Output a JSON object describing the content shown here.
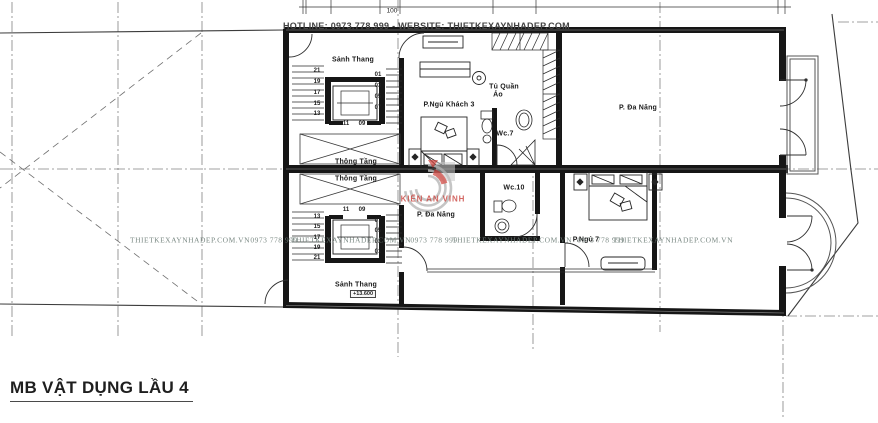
{
  "header": {
    "hotline": "HOTLINE: 0973.778.999 - WEBSITE: THIETKEXAYNHADEP.COM"
  },
  "title": {
    "text": "MB VẬT DỤNG LẦU 4"
  },
  "dimensions": {
    "top_width_label": "100"
  },
  "rooms": {
    "stair_hall_top": "Sảnh Thang",
    "guest_bedroom": "P.Ngủ Khách 3",
    "wardrobe_line1": "Tủ Quần",
    "wardrobe_line2": "Áo",
    "wc7": "Wc.7",
    "multi_top": "P. Đa Năng",
    "void_top": "Thông Tầng",
    "void_bottom": "Thông Tầng",
    "wc10": "Wc.10",
    "multi_bottom": "P. Đa Năng",
    "bedroom7": "P.Ngủ 7",
    "stair_hall_bottom": "Sảnh Thang",
    "stair_elevation": "+13.600"
  },
  "stairs": {
    "top": {
      "left": [
        "21",
        "19",
        "17",
        "15",
        "13"
      ],
      "mid": [
        "11",
        "09"
      ],
      "right": [
        "01",
        "03",
        "05",
        "07"
      ]
    },
    "bottom": {
      "mid": [
        "11",
        "09"
      ],
      "left": [
        "13",
        "15",
        "17",
        "19",
        "21"
      ],
      "right": [
        "07",
        "05",
        "03",
        "01"
      ]
    }
  },
  "watermark": {
    "site": "THIETKEXAYNHADEP.COM.VN",
    "phone": "0973 778 999",
    "logo_text": "KIẾN AN VINH"
  },
  "colors": {
    "wall": "#161616",
    "logo_red": "#cf443e",
    "logo_gray": "#bcbcbc",
    "watermark_text": "#6e7e78"
  }
}
